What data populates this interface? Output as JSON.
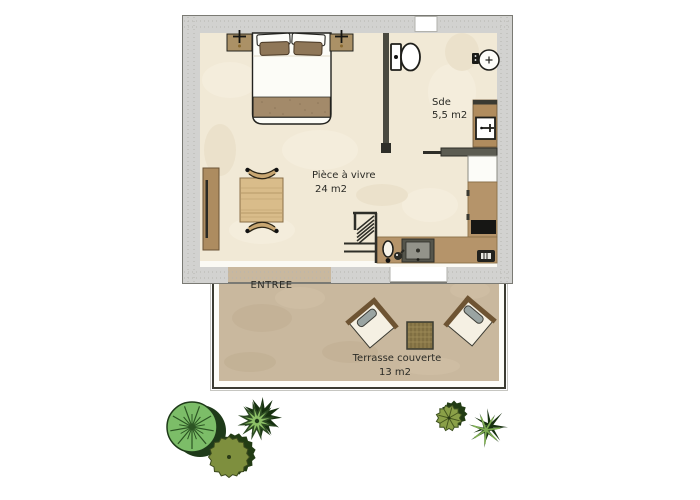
{
  "plan": {
    "rooms": {
      "living": {
        "name": "Pièce à vivre",
        "area": "24 m2"
      },
      "shower_room": {
        "name": "Sde",
        "area": "5,5 m2"
      },
      "terrace": {
        "name": "Terrasse couverte",
        "area": "13 m2"
      }
    },
    "entrance": {
      "label": "ENTREE"
    }
  },
  "colors": {
    "wall_gray": "#d2d2d0",
    "floor_cream": "#f1e9d6",
    "terrace_tan": "#c9b89e",
    "outline_dark": "#3c3c32",
    "wood_brown": "#ad8c60",
    "counter_brown": "#b5946a",
    "table_wood": "#d9bc8a",
    "cushion_gray": "#9aa4a2",
    "cooktop_black": "#161614",
    "plant_light_green": "#7cbd68",
    "plant_dark_green": "#24401e",
    "plant_olive": "#7e8f3e",
    "text_dark": "#2b2b26"
  }
}
